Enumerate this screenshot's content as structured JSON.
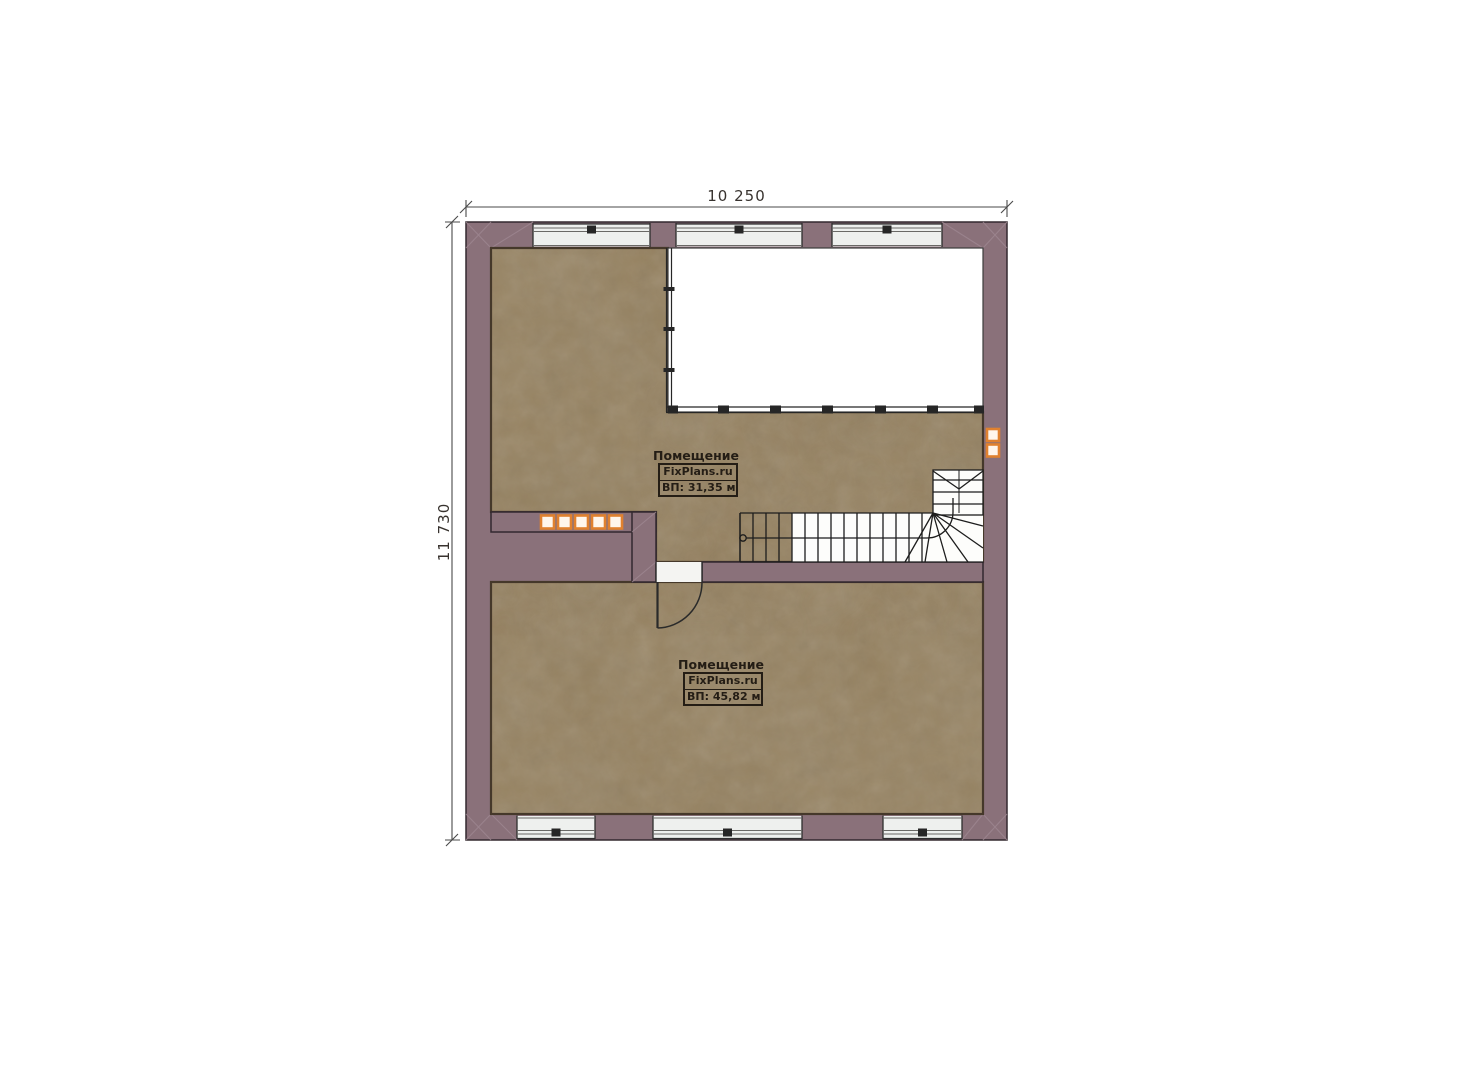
{
  "plan": {
    "title": "Floor plan",
    "dimensions": {
      "width_label": "10 250",
      "height_label": "11 730"
    },
    "rooms": [
      {
        "type_label": "Помещение",
        "brand": "FixPlans.ru",
        "area_label": "ВП: 31,35 м²"
      },
      {
        "type_label": "Помещение",
        "brand": "FixPlans.ru",
        "area_label": "ВП: 45,82 м²"
      }
    ],
    "colors": {
      "wall": "#8a717a",
      "wall_corner": "#97808a",
      "floor": "#95815f",
      "floor_outline": "#45382a",
      "window_glass": "#eef0ee",
      "accent_orange": "#e0812f",
      "line": "#2c2c2c"
    }
  }
}
